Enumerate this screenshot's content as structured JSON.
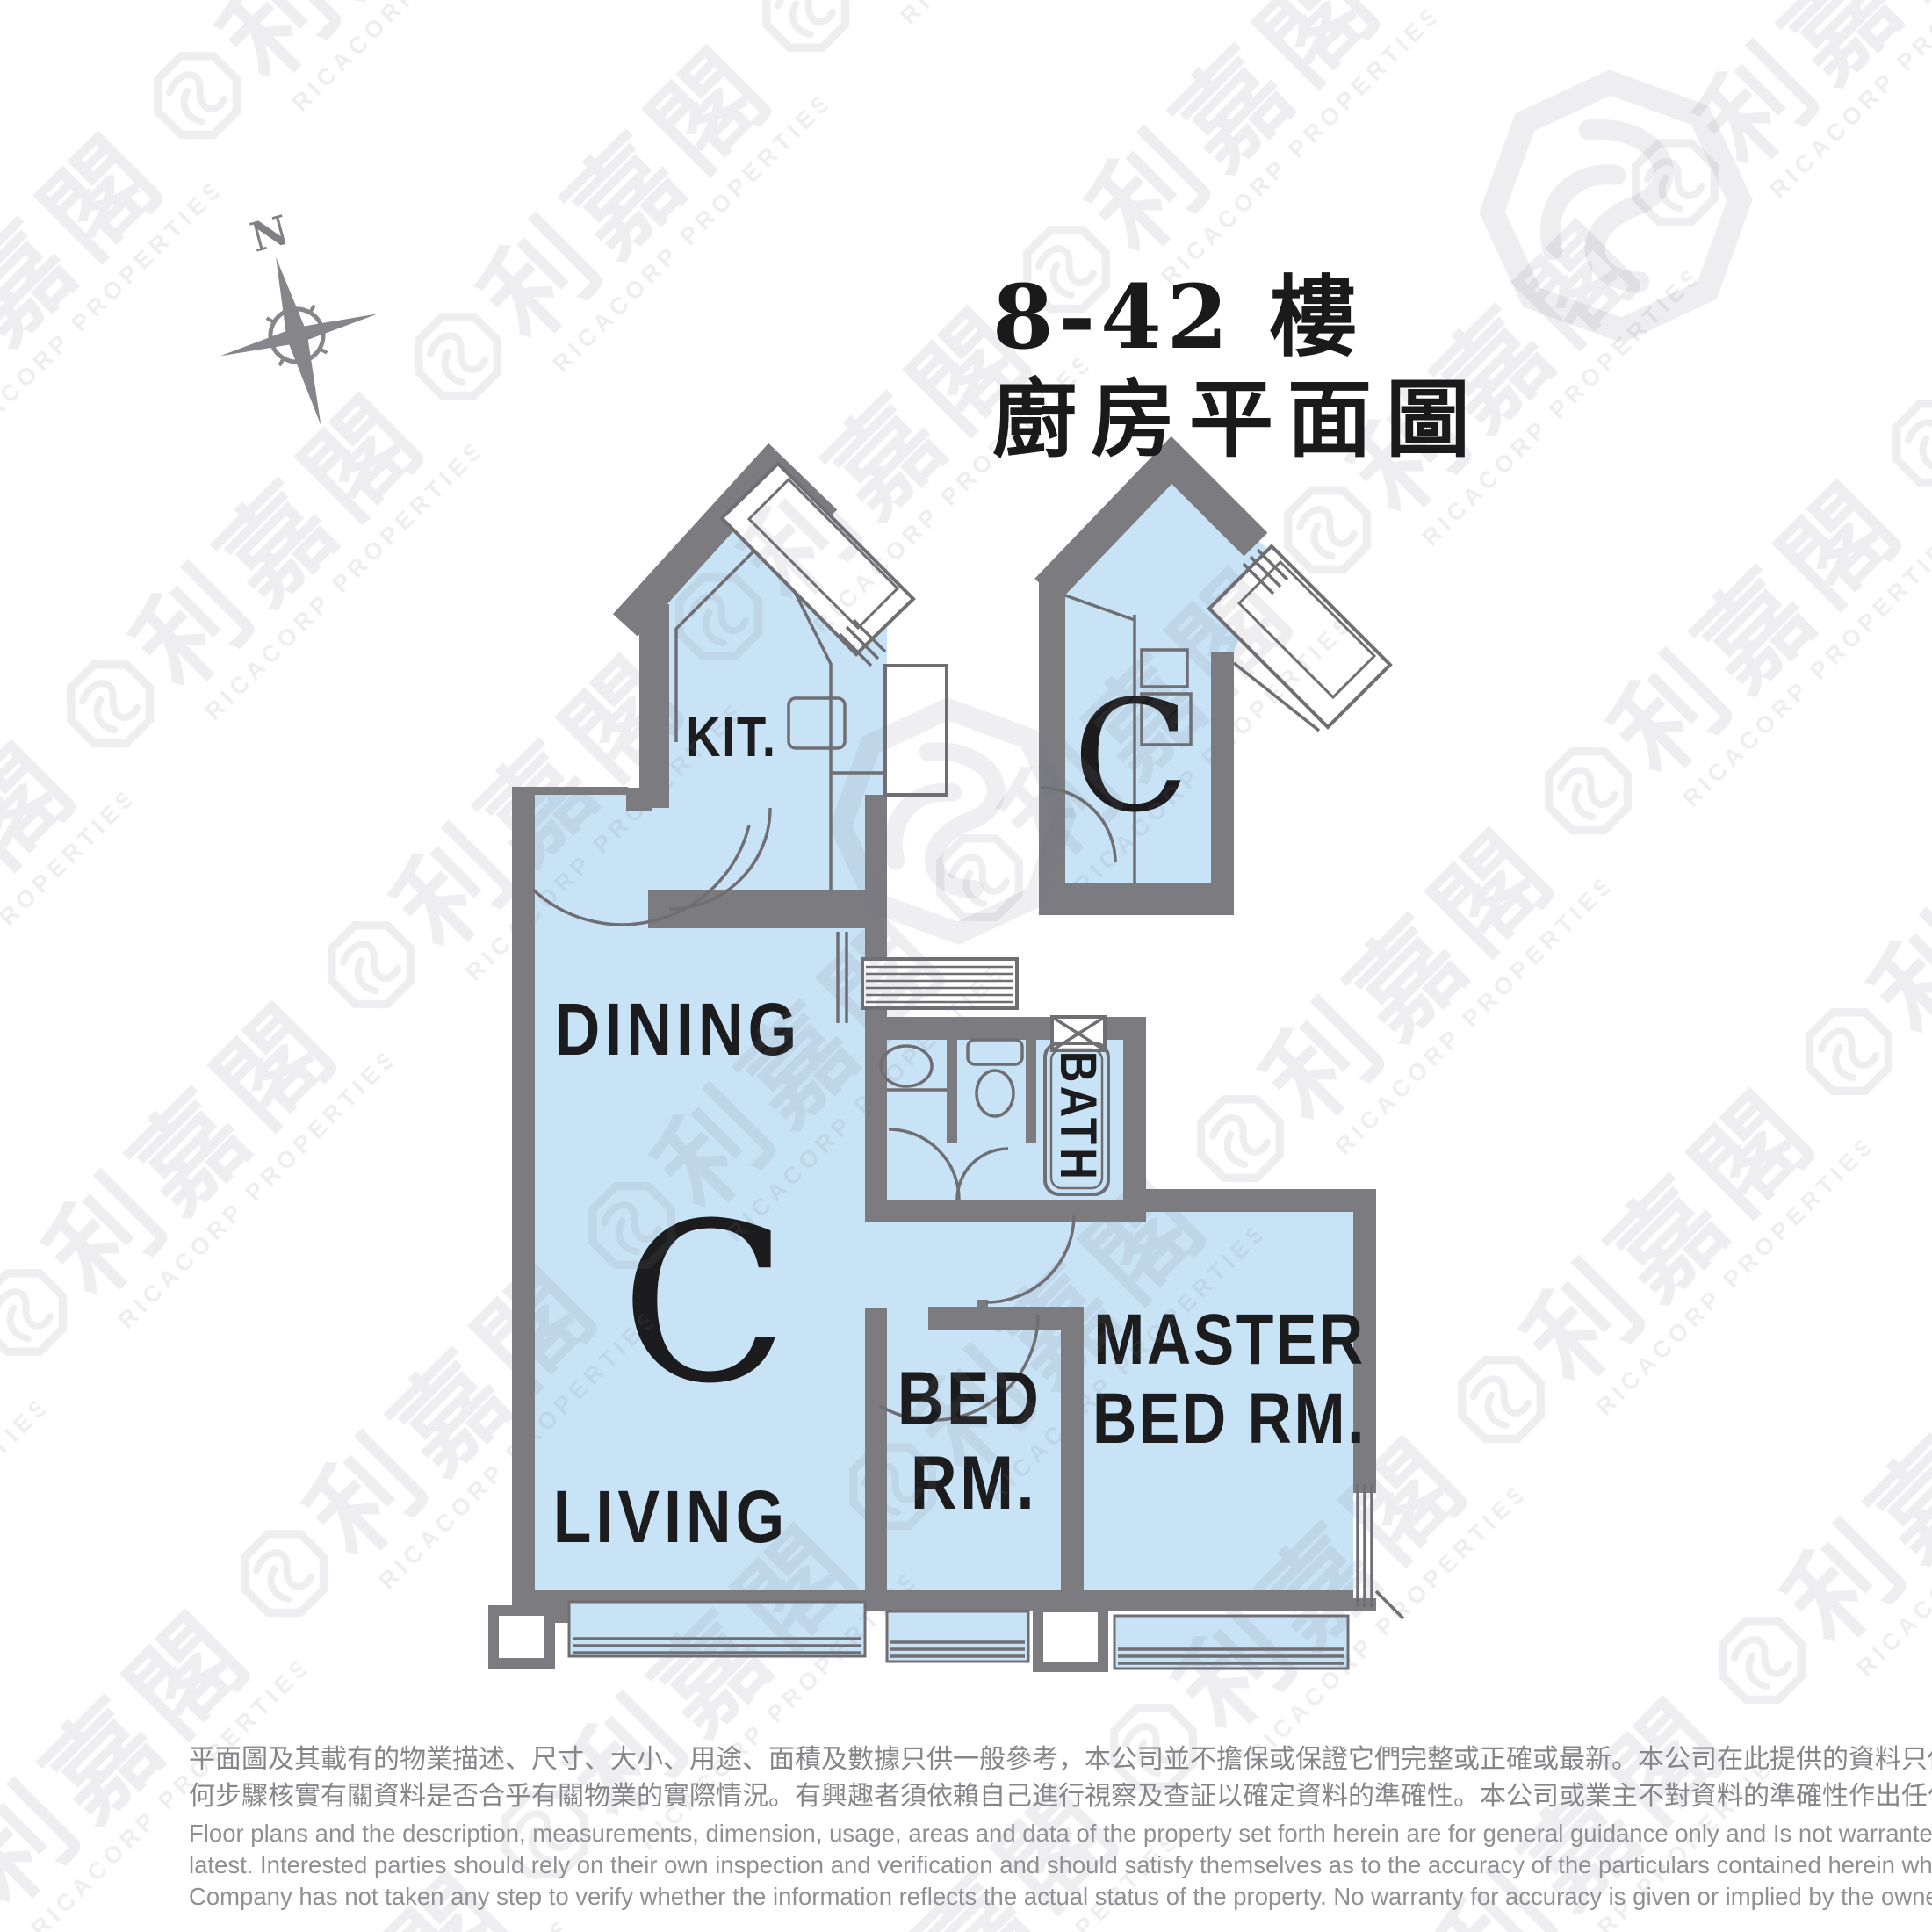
{
  "title": {
    "line1": "8-42 樓",
    "line2": "廚房平面圖"
  },
  "compass": {
    "north": "N"
  },
  "plan": {
    "unit_letter": "C",
    "kitchen_detail_letter": "C",
    "rooms": {
      "kit": "KIT.",
      "dining": "DINING",
      "living": "LIVING",
      "bed_l1": "BED",
      "bed_l2": "RM.",
      "master_l1": "MASTER",
      "master_l2": "BED RM.",
      "bath": "BATH"
    }
  },
  "watermark": {
    "cjk": "利嘉閣",
    "latin": "RICACORP PROPERTIES"
  },
  "colors": {
    "floor": "#c9e3f6",
    "wall": "#7c7c80",
    "thin_line": "#6e6e73",
    "label": "#1c1c1e",
    "title": "#1a1a1a",
    "watermark": "#6f6f80",
    "disclaimer_zh": "#85858a",
    "disclaimer_en": "#8f8f94"
  },
  "disclaimer": {
    "zh1": "平面圖及其載有的物業描述、尺寸、大小、用途、面積及數據只供一般參考，本公司並不擔保或保證它們完整或正確或最新。本公司在此提供的資料只供閣下參考，本公司並無採取任",
    "zh2": "何步驟核實有關資料是否合乎有關物業的實際情況。有興趣者須依賴自己進行視察及查証以確定資料的準確性。本公司或業主不對資料的準確性作出任何明示或隱含的保證。",
    "en1": "Floor plans and the description, measurements, dimension, usage, areas and data of the property set forth herein are for general guidance only and Is not warranted or guaranteed to be complete or correct or the",
    "en2": "latest. Interested parties should rely on their own inspection and verification and should satisfy themselves as to the accuracy of the particulars contained herein which are provided by us for information only.  Our",
    "en3": "Company has not taken any step to verify whether the information reflects the actual status of the property.  No warranty for accuracy is given or implied by the owners or us."
  }
}
